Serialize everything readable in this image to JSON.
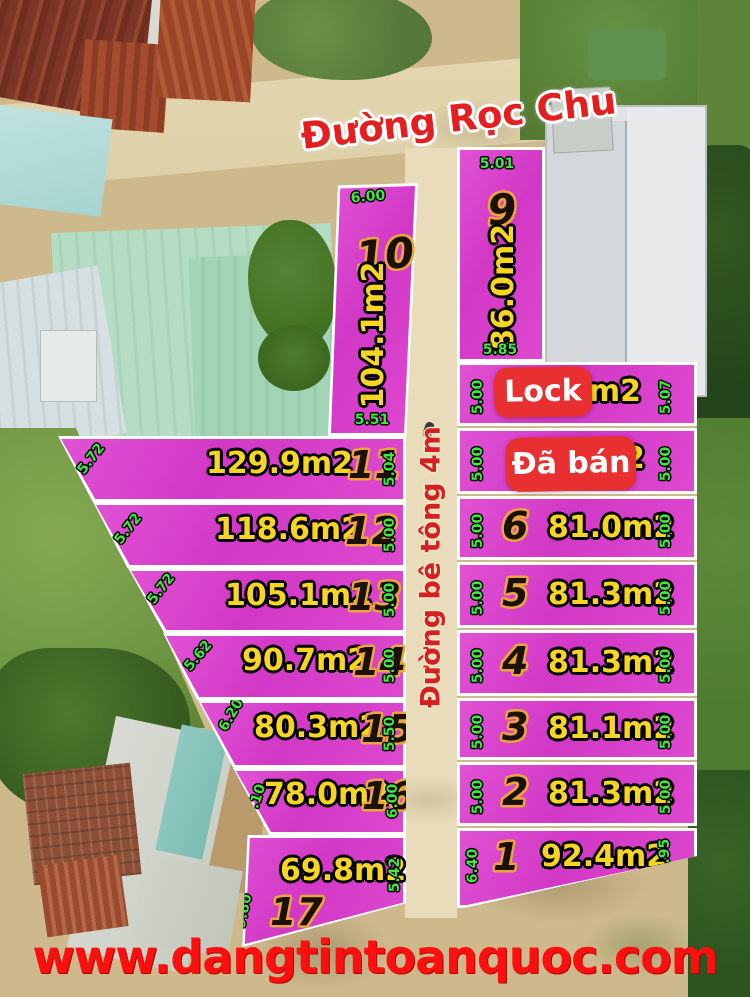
{
  "header": {
    "street_name": "Đường Rọc Chu"
  },
  "center_road": {
    "label": "Đường bê tông 4m"
  },
  "watermark": {
    "url_text": "www.dangtintoanquoc.com"
  },
  "badges": {
    "lock_label": "Lock",
    "sold_label": "Đã bán"
  },
  "colors": {
    "plot_pink": "#d93fcf",
    "boundary_white": "#ffffff",
    "dim_green": "#3fe83f",
    "area_yellow": "#f7d621",
    "number_black": "#1a1206",
    "number_outline_orange": "#eda43c",
    "badge_red": "#e93030",
    "street_red": "#e51f1f",
    "watermark_red": "#fb0f0f",
    "road_cream": "#e8dcba"
  },
  "plots": [
    {
      "number": "1",
      "area": "92.4m2",
      "dim_left": "6.40",
      "dim_right": "4.95"
    },
    {
      "number": "2",
      "area": "81.3m2",
      "dim_left": "5.00",
      "dim_right": "5.00"
    },
    {
      "number": "3",
      "area": "81.1m2",
      "dim_left": "5.00",
      "dim_right": "5.00"
    },
    {
      "number": "4",
      "area": "81.3m2",
      "dim_left": "5.00",
      "dim_right": "5.00"
    },
    {
      "number": "5",
      "area": "81.3m2",
      "dim_left": "5.00",
      "dim_right": "5.00"
    },
    {
      "number": "6",
      "area": "81.0m2",
      "dim_left": "5.00",
      "dim_right": "5.00"
    },
    {
      "number": "",
      "area_fragment": "2",
      "badge": "Đã bán",
      "dim_left": "5.00",
      "dim_right": "5.00"
    },
    {
      "number": "",
      "area_fragment": "7m2",
      "badge": "Lock",
      "dim_left": "5.00",
      "dim_right": "5.07"
    },
    {
      "number": "9",
      "area": "86.0m2",
      "dim_top": "5.01",
      "dim_bottom": "5.85"
    },
    {
      "number": "10",
      "area": "104.1m2",
      "dim_top": "6.00",
      "dim_bottom": "5.51"
    },
    {
      "number": "11",
      "area": "129.9m2",
      "dim_left": "5.72",
      "dim_right": "5.04"
    },
    {
      "number": "12",
      "area": "118.6m2",
      "dim_left": "5.72",
      "dim_right": "5.00"
    },
    {
      "number": "13",
      "area": "105.1m2",
      "dim_left": "5.72",
      "dim_right": "5.00"
    },
    {
      "number": "14",
      "area": "90.7m2",
      "dim_left": "5.62",
      "dim_right": "5.00"
    },
    {
      "number": "15",
      "area": "80.3m2",
      "dim_left": "6.20",
      "dim_right": "5.50"
    },
    {
      "number": "16",
      "area": "78.0m2",
      "dim_left": "7.10",
      "dim_right": "6.00"
    },
    {
      "number": "17",
      "area": "69.8m2",
      "dim_left": "9.80",
      "dim_right": "5.42"
    }
  ]
}
